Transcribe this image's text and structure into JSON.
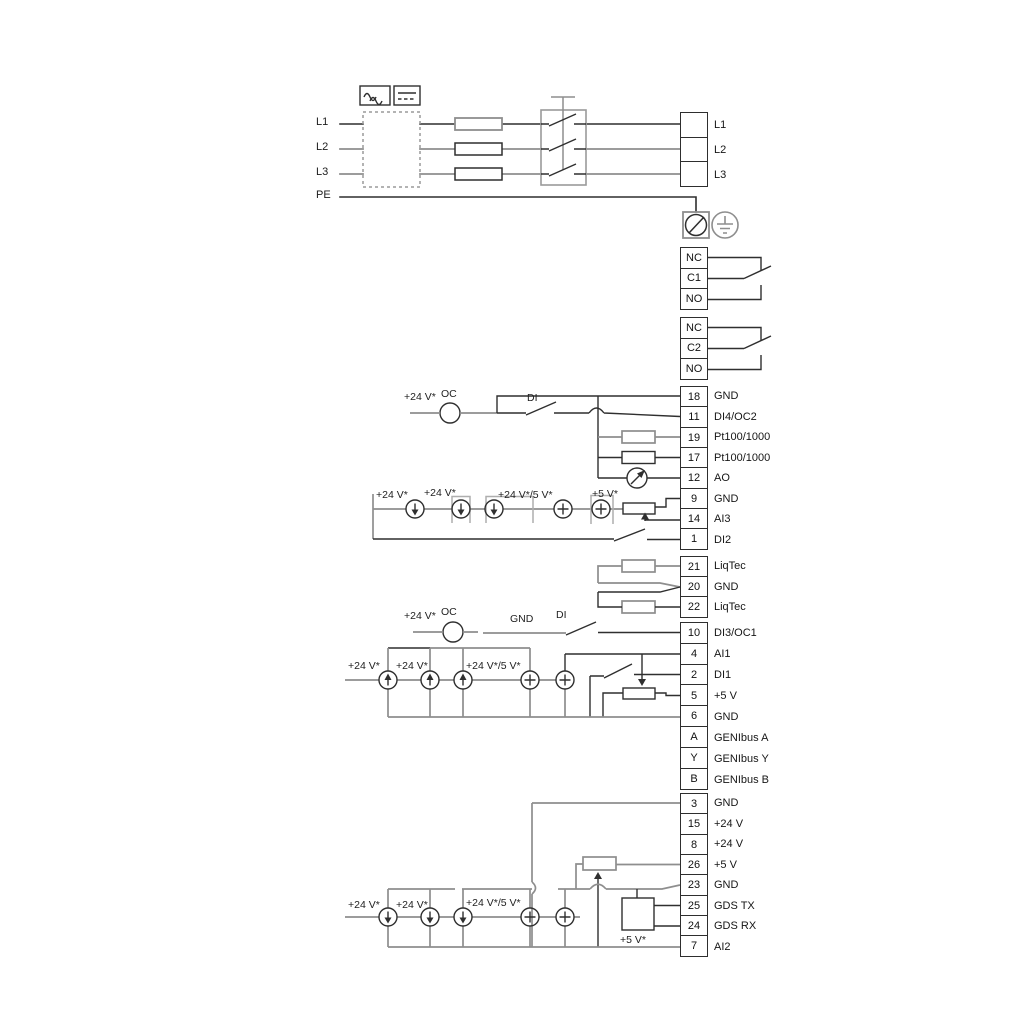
{
  "left_labels": [
    "L1",
    "L2",
    "L3",
    "PE"
  ],
  "mains_block": [
    "L1",
    "L2",
    "L3"
  ],
  "mains_out_labels": [
    "L1",
    "L2",
    "L3"
  ],
  "relay1": [
    "NC",
    "C1",
    "NO"
  ],
  "relay2": [
    "NC",
    "C2",
    "NO"
  ],
  "io_mid": [
    {
      "num": "18",
      "label": "GND"
    },
    {
      "num": "11",
      "label": "DI4/OC2"
    },
    {
      "num": "19",
      "label": "Pt100/1000"
    },
    {
      "num": "17",
      "label": "Pt100/1000"
    },
    {
      "num": "12",
      "label": "AO"
    },
    {
      "num": "9",
      "label": "GND"
    },
    {
      "num": "14",
      "label": "AI3"
    },
    {
      "num": "1",
      "label": "DI2"
    }
  ],
  "liqtec_block": [
    {
      "num": "21",
      "label": "LiqTec"
    },
    {
      "num": "20",
      "label": "GND"
    },
    {
      "num": "22",
      "label": "LiqTec"
    }
  ],
  "io_low": [
    {
      "num": "10",
      "label": "DI3/OC1"
    },
    {
      "num": "4",
      "label": "AI1"
    },
    {
      "num": "2",
      "label": "DI1"
    },
    {
      "num": "5",
      "label": "+5 V"
    },
    {
      "num": "6",
      "label": "GND"
    },
    {
      "num": "A",
      "label": "GENIbus A"
    },
    {
      "num": "Y",
      "label": "GENIbus Y"
    },
    {
      "num": "B",
      "label": "GENIbus B"
    }
  ],
  "io_bottom": [
    {
      "num": "3",
      "label": "GND"
    },
    {
      "num": "15",
      "label": "+24 V"
    },
    {
      "num": "8",
      "label": "+24 V"
    },
    {
      "num": "26",
      "label": "+5 V"
    },
    {
      "num": "23",
      "label": "GND"
    },
    {
      "num": "25",
      "label": "GDS TX"
    },
    {
      "num": "24",
      "label": "GDS RX"
    },
    {
      "num": "7",
      "label": "AI2"
    }
  ],
  "annotations": {
    "v24": "+24 V*",
    "v24_5": "+24 V*/5 V*",
    "v5": "+5 V*",
    "oc": "OC",
    "di": "DI",
    "gnd": "GND"
  },
  "colors": {
    "wire_gray": "#8e8e8e",
    "wire_dark": "#2f2f2f"
  }
}
